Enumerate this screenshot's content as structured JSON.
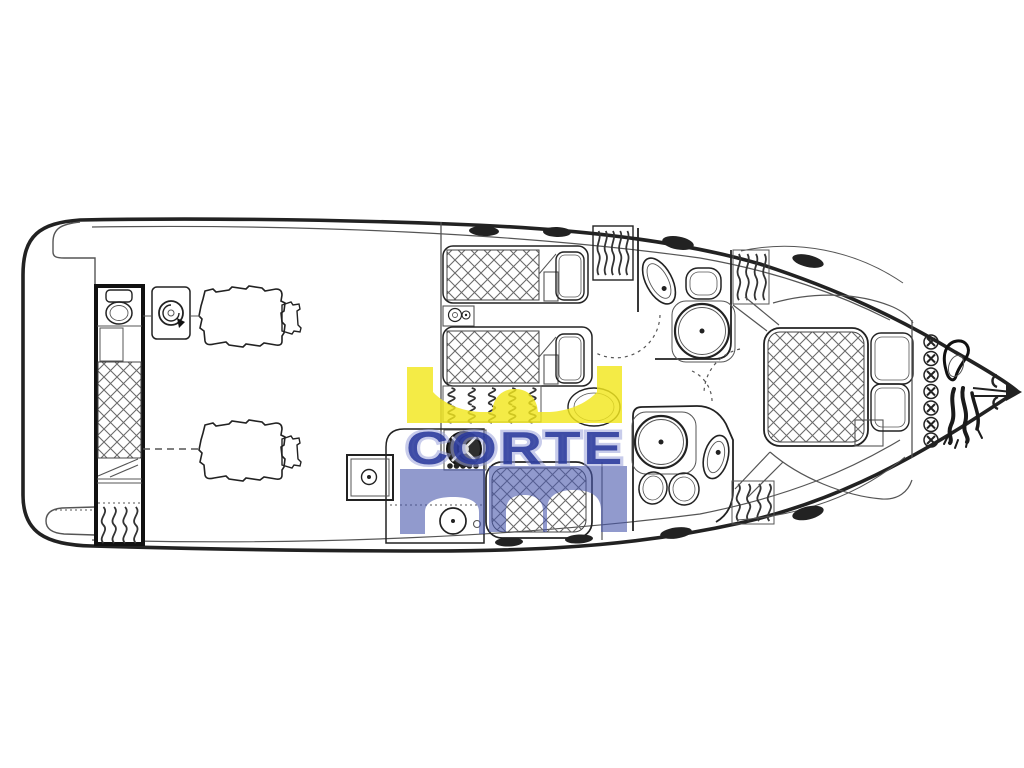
{
  "page": {
    "background": "#ffffff"
  },
  "diagram": {
    "type": "motor-yacht-deck-plan",
    "style": "scanned-line-drawing",
    "ink_color": "#222222",
    "areas": [
      "swim-platform",
      "aft-crew-cabin",
      "engine-room",
      "twin-guest-cabins",
      "galley",
      "dinette",
      "companionway-stairs",
      "forward-head",
      "aft-head",
      "owner-stateroom",
      "bow-anchor-locker"
    ]
  },
  "watermark": {
    "text": "CORTE",
    "crown_color": "#f2e71d",
    "text_color": "#2a3a9c",
    "glow_color": "#9aa3da",
    "panel_color": "#4856ab"
  }
}
